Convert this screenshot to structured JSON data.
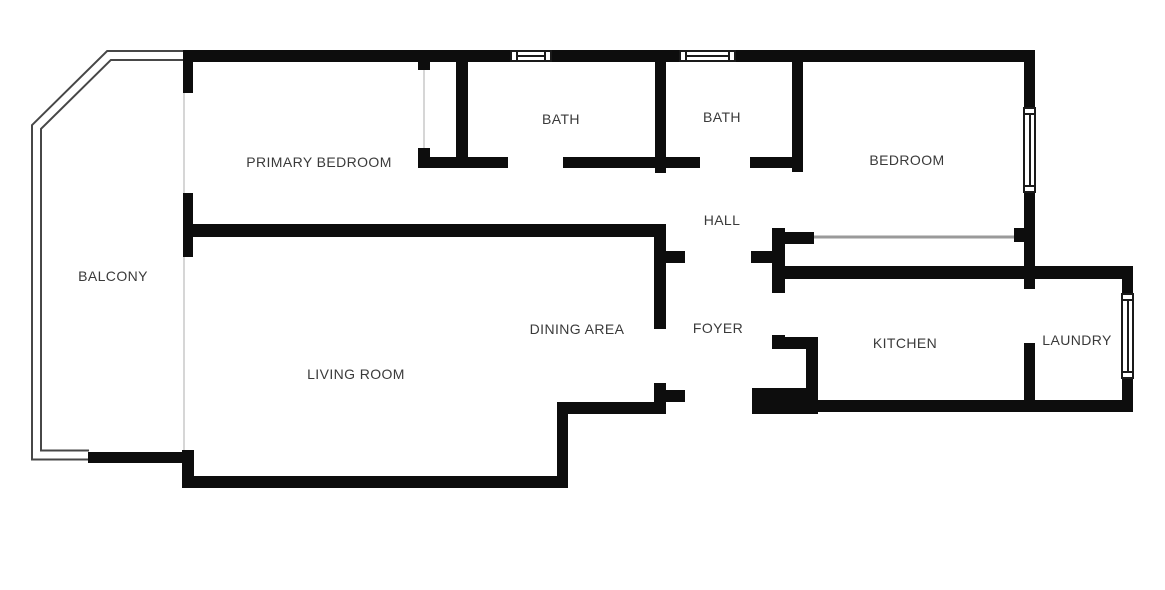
{
  "canvas": {
    "width": 1165,
    "height": 590,
    "background": "#ffffff"
  },
  "colors": {
    "wall": "#0d0d0d",
    "thin_wall_line": "#474747",
    "thin_wall_fill": "#ffffff",
    "faint_line": "#d6d6d6",
    "closet_line": "#9a9a9a",
    "label_text": "#3a3a3a",
    "window_line": "#1a1a1a"
  },
  "rooms": [
    {
      "id": "balcony",
      "label": "BALCONY",
      "cx": 113,
      "cy": 276
    },
    {
      "id": "primary-bedroom",
      "label": "PRIMARY BEDROOM",
      "cx": 319,
      "cy": 162
    },
    {
      "id": "bath-1",
      "label": "BATH",
      "cx": 561,
      "cy": 119
    },
    {
      "id": "bath-2",
      "label": "BATH",
      "cx": 722,
      "cy": 117
    },
    {
      "id": "bedroom",
      "label": "BEDROOM",
      "cx": 907,
      "cy": 160
    },
    {
      "id": "hall",
      "label": "HALL",
      "cx": 722,
      "cy": 220
    },
    {
      "id": "dining-area",
      "label": "DINING AREA",
      "cx": 577,
      "cy": 329
    },
    {
      "id": "foyer",
      "label": "FOYER",
      "cx": 718,
      "cy": 328
    },
    {
      "id": "living-room",
      "label": "LIVING ROOM",
      "cx": 356,
      "cy": 374
    },
    {
      "id": "kitchen",
      "label": "KITCHEN",
      "cx": 905,
      "cy": 343
    },
    {
      "id": "laundry",
      "label": "LAUNDRY",
      "cx": 1077,
      "cy": 340
    }
  ],
  "walls": [
    [
      183,
      50,
      327,
      12
    ],
    [
      552,
      50,
      127,
      12
    ],
    [
      736,
      50,
      299,
      12
    ],
    [
      183,
      50,
      10,
      43
    ],
    [
      183,
      193,
      10,
      64
    ],
    [
      418,
      58,
      12,
      12
    ],
    [
      418,
      148,
      12,
      20
    ],
    [
      418,
      157,
      90,
      11
    ],
    [
      456,
      58,
      12,
      110
    ],
    [
      563,
      157,
      94,
      11
    ],
    [
      655,
      58,
      11,
      115
    ],
    [
      655,
      157,
      45,
      11
    ],
    [
      750,
      157,
      43,
      11
    ],
    [
      792,
      58,
      11,
      114
    ],
    [
      193,
      224,
      461,
      13
    ],
    [
      654,
      224,
      12,
      105
    ],
    [
      666,
      251,
      19,
      12
    ],
    [
      654,
      383,
      12,
      31
    ],
    [
      557,
      402,
      109,
      12
    ],
    [
      557,
      402,
      11,
      86
    ],
    [
      182,
      476,
      386,
      12
    ],
    [
      182,
      450,
      12,
      38
    ],
    [
      88,
      452,
      100,
      11
    ],
    [
      772,
      228,
      13,
      65
    ],
    [
      751,
      251,
      21,
      12
    ],
    [
      772,
      335,
      13,
      14
    ],
    [
      785,
      337,
      33,
      12
    ],
    [
      806,
      337,
      12,
      55
    ],
    [
      752,
      388,
      66,
      26
    ],
    [
      666,
      390,
      19,
      12
    ],
    [
      818,
      400,
      315,
      12
    ],
    [
      772,
      266,
      361,
      13
    ],
    [
      784,
      232,
      30,
      12
    ],
    [
      1014,
      228,
      11,
      14
    ],
    [
      1024,
      50,
      11,
      57
    ],
    [
      1024,
      193,
      11,
      86
    ],
    [
      1024,
      279,
      11,
      10
    ],
    [
      1024,
      343,
      11,
      59
    ],
    [
      1122,
      279,
      11,
      14
    ],
    [
      1122,
      379,
      11,
      23
    ]
  ],
  "windows": [
    {
      "x": 510,
      "y": 50,
      "w": 42,
      "h": 12,
      "orient": "h"
    },
    {
      "x": 679,
      "y": 50,
      "w": 57,
      "h": 12,
      "orient": "h"
    },
    {
      "x": 1023,
      "y": 107,
      "w": 13,
      "h": 86,
      "orient": "v"
    },
    {
      "x": 1121,
      "y": 293,
      "w": 13,
      "h": 86,
      "orient": "v"
    }
  ],
  "balcony_outline": {
    "points": "183,55.5 109,55.5 36.5,127 36.5,455 89,455",
    "outer_width": 11,
    "inner_width": 7
  },
  "faint_lines": [
    {
      "x1": 184,
      "y1": 93,
      "x2": 184,
      "y2": 194
    },
    {
      "x1": 184,
      "y1": 257,
      "x2": 184,
      "y2": 451
    },
    {
      "x1": 424,
      "y1": 70,
      "x2": 424,
      "y2": 148
    }
  ],
  "closet_line": {
    "x1": 814,
    "y1": 237,
    "x2": 1014,
    "y2": 237
  }
}
